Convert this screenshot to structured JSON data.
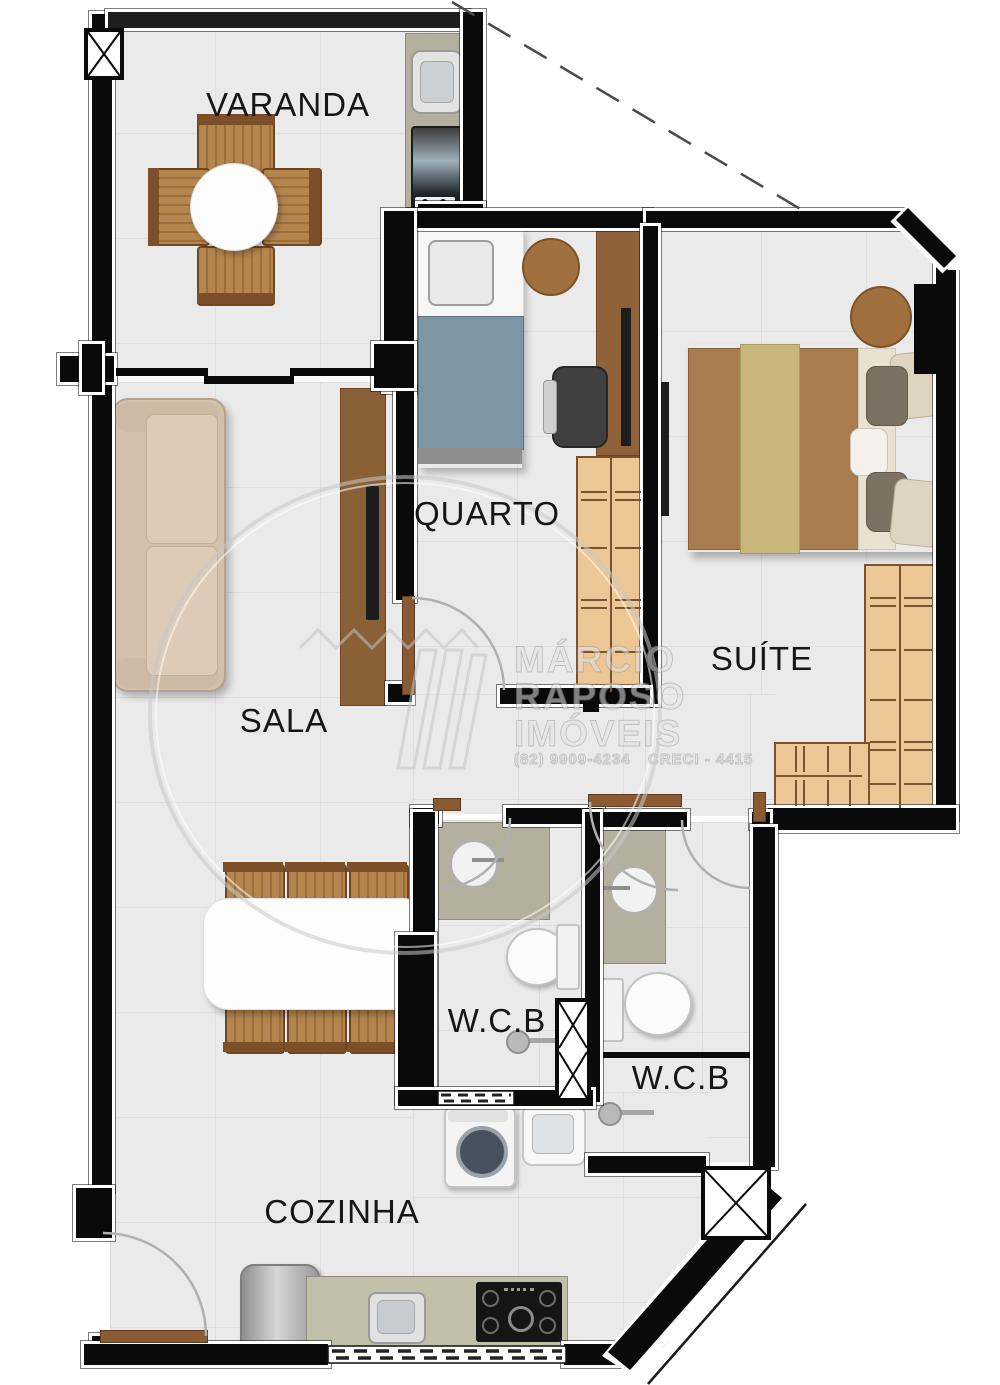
{
  "plan": {
    "type": "apartment-floor-plan",
    "rooms": {
      "varanda": {
        "label": "VARANDA"
      },
      "quarto": {
        "label": "QUARTO"
      },
      "suite": {
        "label": "SUÍTE"
      },
      "sala": {
        "label": "SALA"
      },
      "wcb1": {
        "label": "W.C.B"
      },
      "wcb2": {
        "label": "W.C.B"
      },
      "cozinha": {
        "label": "COZINHA"
      }
    },
    "watermark": {
      "line1": "MÁRCIO",
      "line2": "RAPOSO",
      "line3": "IMÓVEIS",
      "phone": "(82) 9909-4234",
      "creci": "CRECI - 4415"
    },
    "colors": {
      "wall": "#0a0a0a",
      "floor": "#eaeaea",
      "wood": "#8a5a33",
      "light_wood": "#ecc795",
      "stone_counter": "#b4b09f",
      "single_bed_blanket": "#7e95a6",
      "double_bed_blanket": "#a87c4e"
    }
  }
}
